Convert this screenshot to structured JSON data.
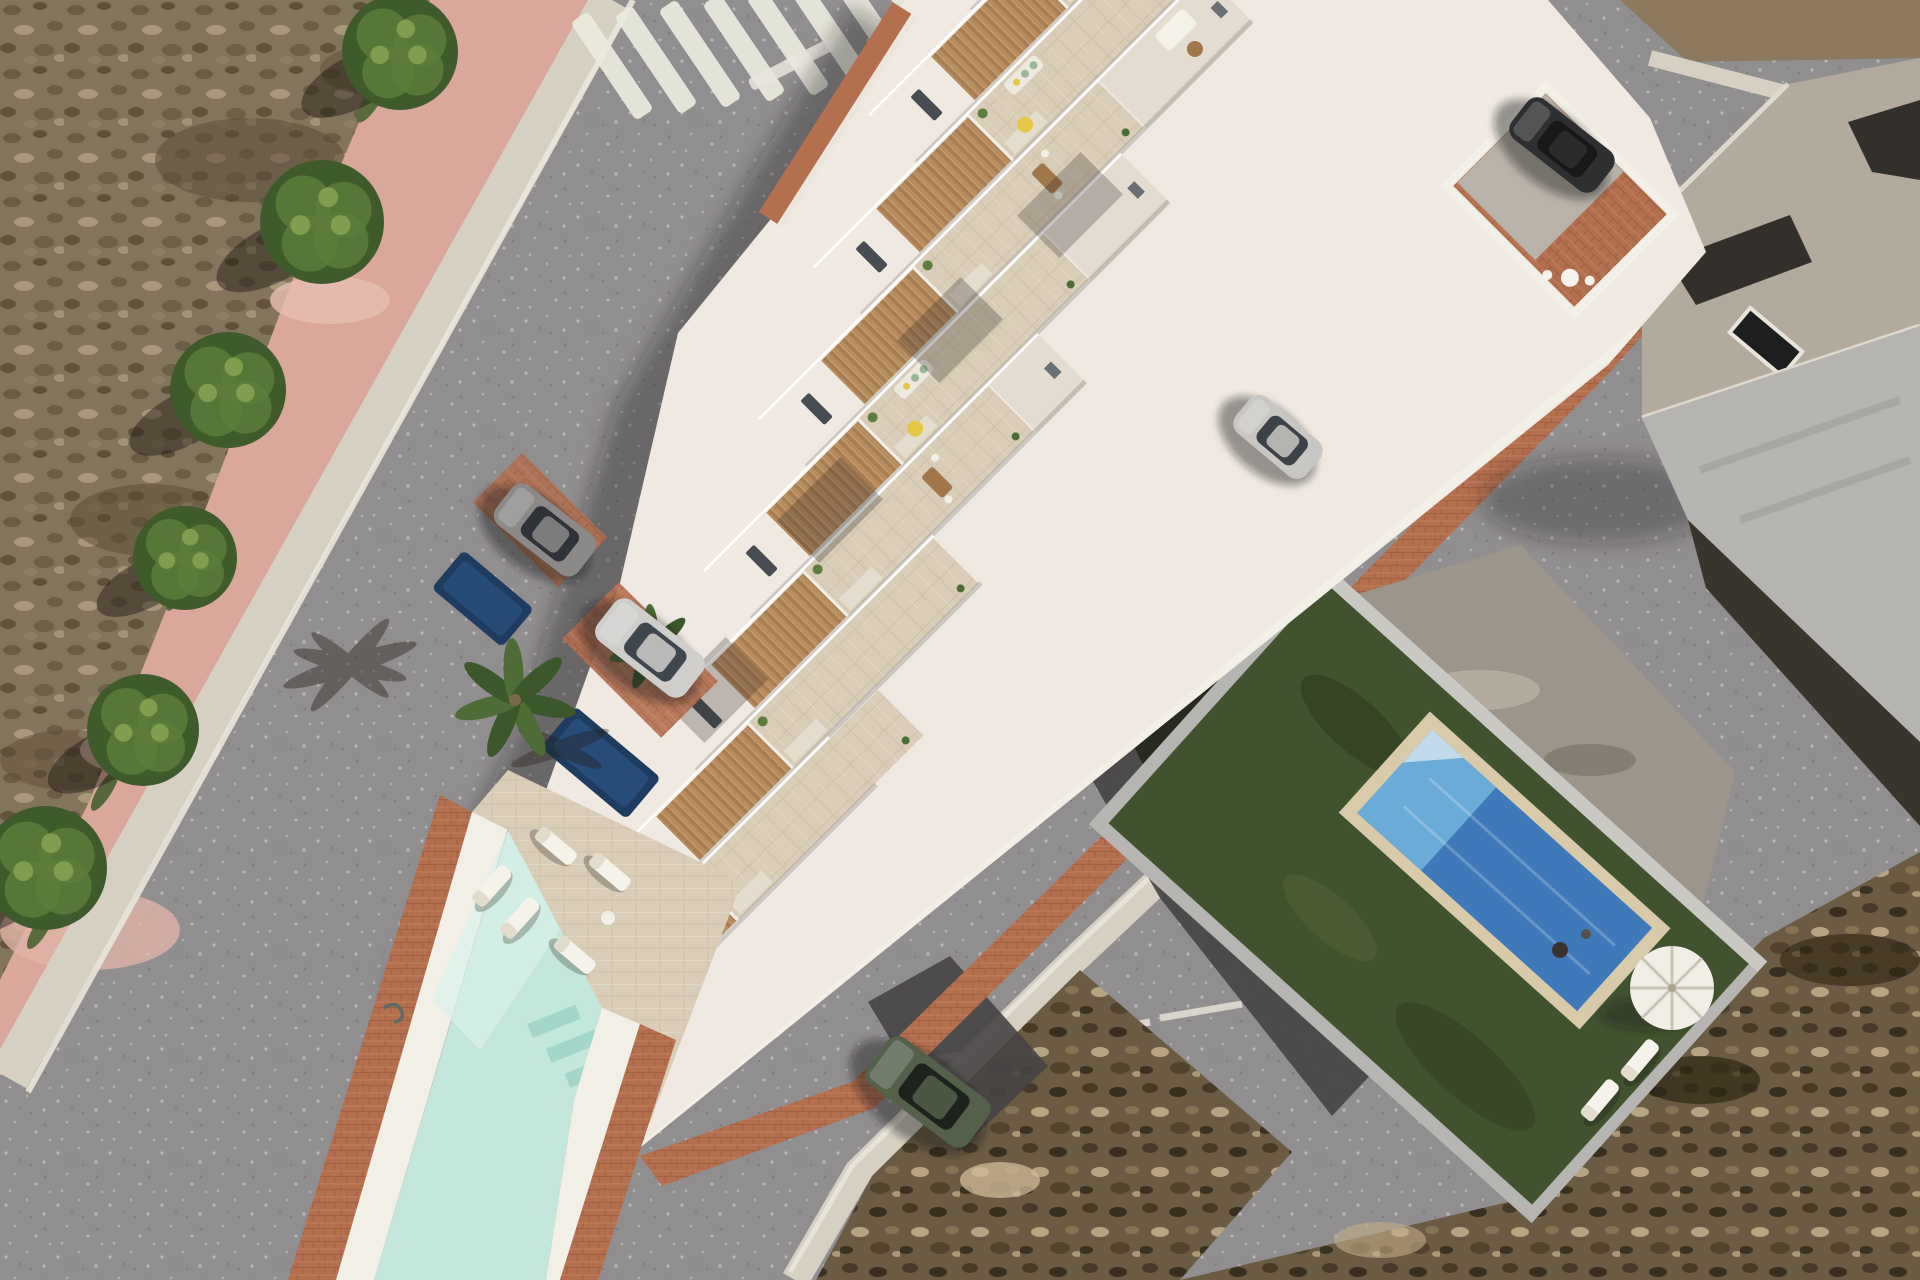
{
  "scene": {
    "title": "Aerial render of a new white townhouse complex with rooftop terraces, communal pool, streets and neighbouring villa with blue pool",
    "townhouse_units": 8,
    "crosswalk_stripes": 8
  },
  "palette": {
    "road": "#918e90",
    "curb": "#d6d0c3",
    "white2": "#f2efe7",
    "wall": "#efe9e1",
    "wallShade": "#e4dcd1",
    "tileLine": "#bfae92",
    "wood": "#b78d60",
    "woodDark": "#a1764b",
    "brick": "#b46f4e",
    "brickDark": "#8f5336",
    "mint": "#c3e8db",
    "mintLight": "#d8f1e8",
    "mintDark": "#9fd4c5",
    "poolBlue": "#3f79ba",
    "poolBlueLight": "#6fb0da",
    "poolBorder": "#d9cbaa",
    "lawn": "#41522f",
    "lawnDark": "#2e3c21",
    "treeGreen": "#3f5a2b",
    "treeLight": "#5f7d3c",
    "palmGreen": "#4e6d36",
    "oldRoof": "#b2aa9d",
    "oldWall": "#b6b4b1",
    "oldDark": "#37352c",
    "sidewalk": "#d9a89b",
    "yellow": "#e5c645",
    "sofaGreen": "#9cb698",
    "asphaltPatch": "#474445"
  },
  "trees": [
    {
      "x": 400,
      "y": 52,
      "r": 58
    },
    {
      "x": 322,
      "y": 222,
      "r": 62
    },
    {
      "x": 228,
      "y": 390,
      "r": 58
    },
    {
      "x": 185,
      "y": 558,
      "r": 52
    },
    {
      "x": 143,
      "y": 730,
      "r": 56
    },
    {
      "x": 45,
      "y": 868,
      "r": 62
    }
  ],
  "palms": [
    {
      "x": 515,
      "y": 700,
      "r": 62
    },
    {
      "x": 652,
      "y": 648,
      "r": 44
    }
  ],
  "crosswalk": {
    "cx": 612,
    "cy": 66,
    "count": 8,
    "gap": 44,
    "dy": -6,
    "angle": -34,
    "len": 118,
    "w": 21
  },
  "unitGrid": {
    "x": 930,
    "y": -45,
    "dx": -55,
    "dy": 152,
    "w": 70
  },
  "units": [
    {
      "len": 760,
      "table": false,
      "sofa": false,
      "beanbag": false
    },
    {
      "len": 700,
      "table": true,
      "sofa": false,
      "beanbag": false
    },
    {
      "len": 660,
      "table": false,
      "sofa": true,
      "beanbag": true
    },
    {
      "len": 620,
      "table": true,
      "sofa": false,
      "beanbag": false
    },
    {
      "len": 580,
      "table": false,
      "sofa": true,
      "beanbag": true
    },
    {
      "len": 540,
      "table": true,
      "sofa": false,
      "beanbag": false
    },
    {
      "len": 470,
      "table": false,
      "sofa": false,
      "beanbag": false
    },
    {
      "len": 400,
      "table": false,
      "sofa": false,
      "beanbag": false
    }
  ],
  "loungers": [
    {
      "x": 556,
      "y": 846,
      "a": 40
    },
    {
      "x": 610,
      "y": 872,
      "a": 40
    },
    {
      "x": 520,
      "y": 918,
      "a": -48
    },
    {
      "x": 575,
      "y": 955,
      "a": 40
    },
    {
      "x": 492,
      "y": 886,
      "a": -48
    },
    {
      "x": 1640,
      "y": 1060,
      "a": -50
    },
    {
      "x": 1600,
      "y": 1100,
      "a": -50
    }
  ],
  "cars": [
    {
      "name": "dark-sedan-corner",
      "x": 1562,
      "y": 145,
      "a": 38,
      "len": 108,
      "wid": 50,
      "body": "#2e2f31",
      "glass": "#17181a"
    },
    {
      "name": "silver-sedan-driveway",
      "x": 650,
      "y": 648,
      "a": 38,
      "len": 112,
      "wid": 52,
      "body": "#cfcecb",
      "glass": "#3f464d"
    },
    {
      "name": "gray-car-shade",
      "x": 545,
      "y": 530,
      "a": 38,
      "len": 104,
      "wid": 50,
      "body": "#8b8a88",
      "glass": "#2f3236"
    },
    {
      "name": "silver-car-patio",
      "x": 1278,
      "y": 437,
      "a": 40,
      "len": 92,
      "wid": 46,
      "body": "#c8c7c3",
      "glass": "#3c4247"
    },
    {
      "name": "green-suv-street",
      "x": 928,
      "y": 1092,
      "a": 37,
      "len": 126,
      "wid": 58,
      "body": "#54604a",
      "glass": "#1d221d"
    }
  ]
}
